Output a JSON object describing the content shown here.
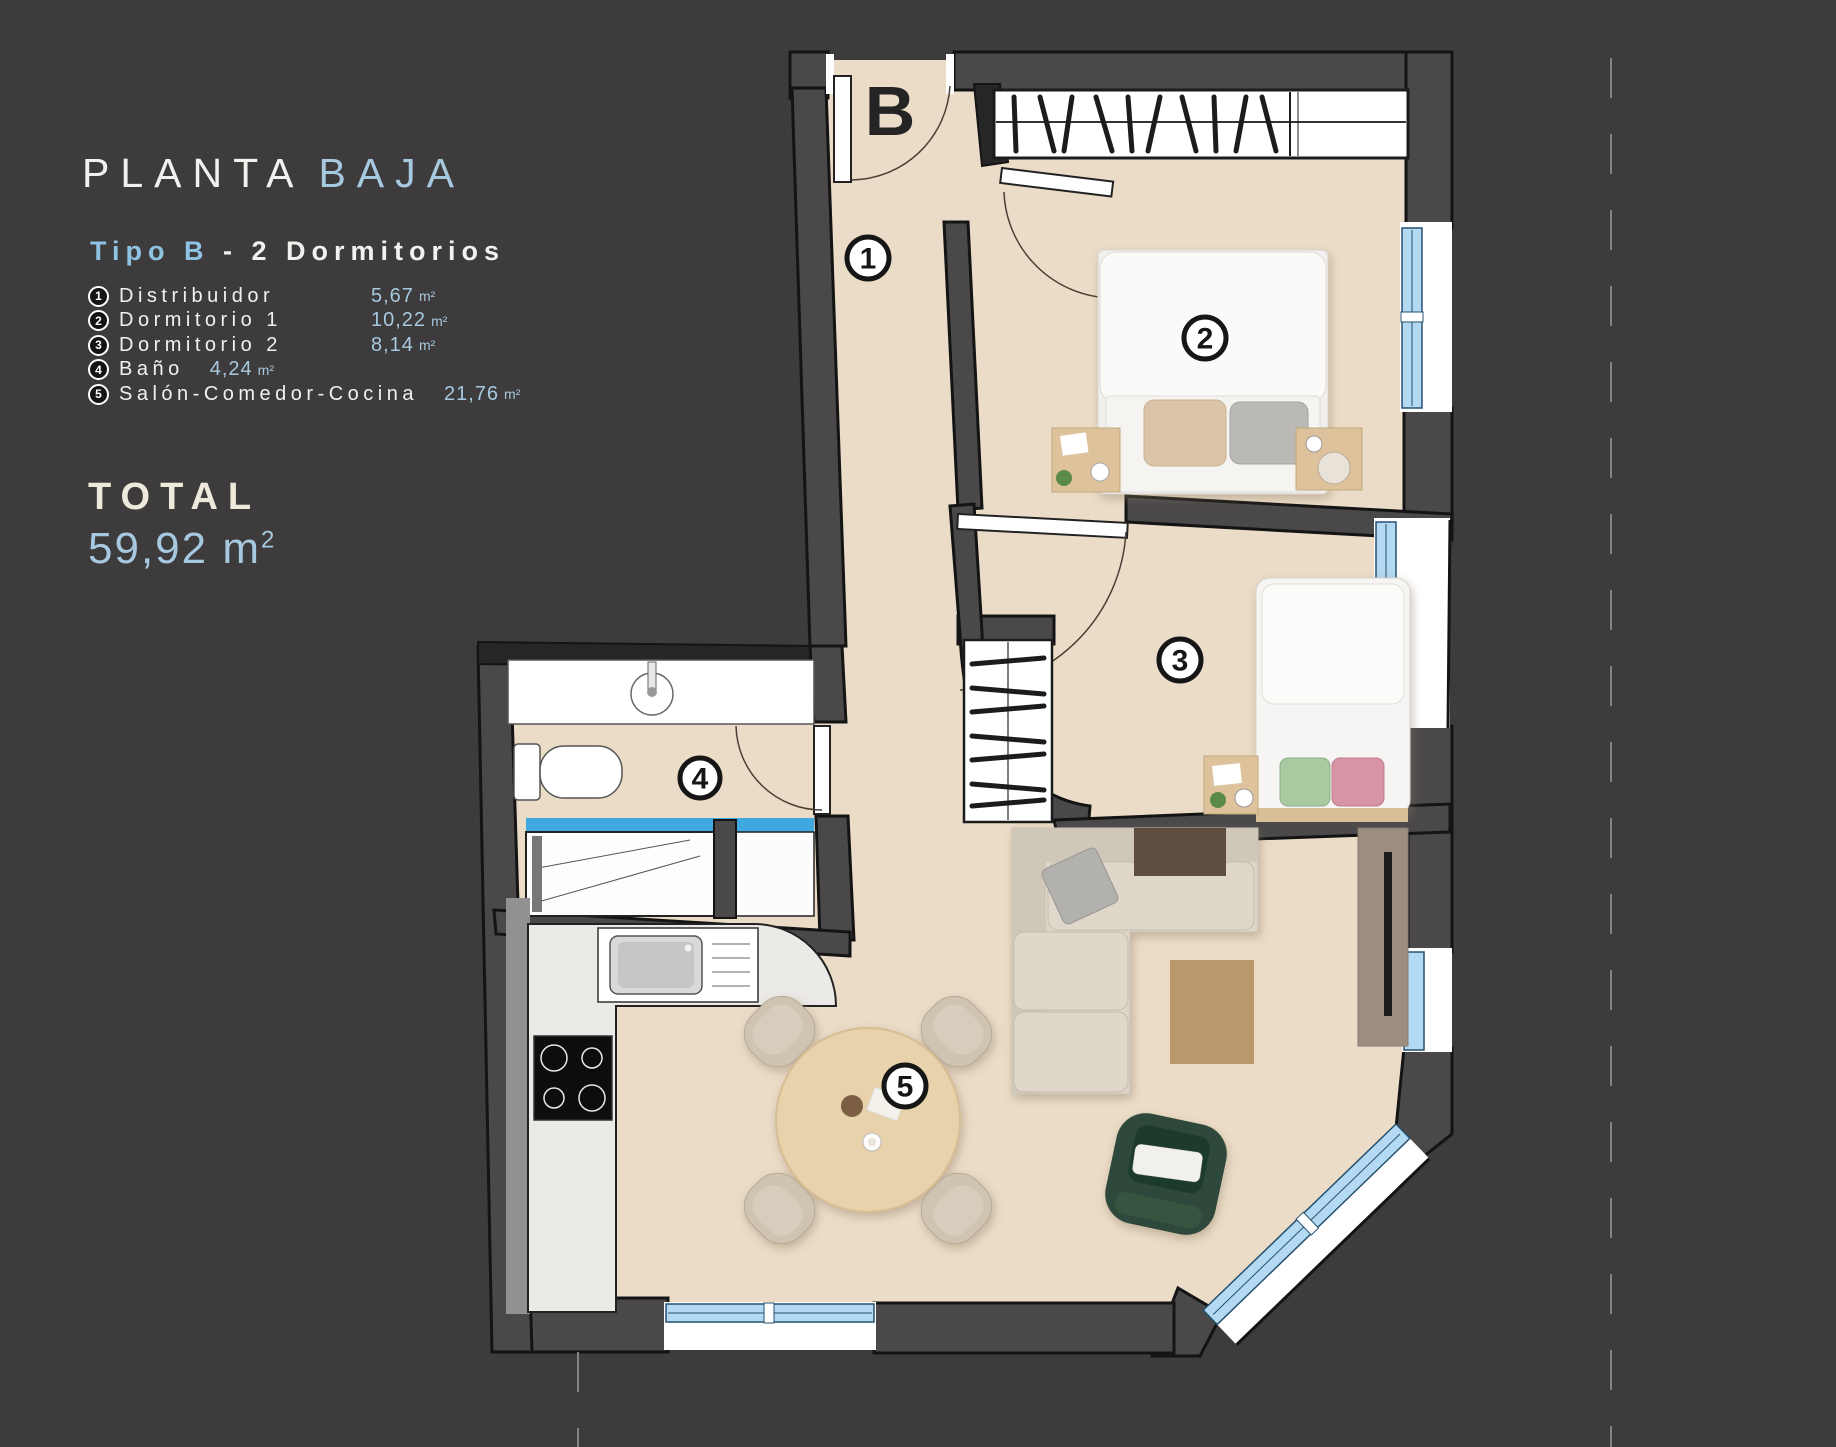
{
  "title": {
    "part1": "PLANTA",
    "part2": "BAJA"
  },
  "subtitle": {
    "part1": "Tipo B",
    "part2": "- 2 Dormitorios"
  },
  "legend": {
    "items": [
      {
        "num": "1",
        "label": "Distribuidor",
        "value": "5,67",
        "unit": "m²"
      },
      {
        "num": "2",
        "label": "Dormitorio 1",
        "value": "10,22",
        "unit": "m²"
      },
      {
        "num": "3",
        "label": "Dormitorio 2",
        "value": "8,14",
        "unit": "m²"
      },
      {
        "num": "4",
        "label": "Baño",
        "value": "4,24",
        "unit": "m²"
      },
      {
        "num": "5",
        "label": "Salón-Comedor-Cocina",
        "value": "21,76",
        "unit": "m²"
      }
    ]
  },
  "total": {
    "label": "TOTAL",
    "value": "59,92",
    "unit": "m",
    "sup": "2"
  },
  "plan": {
    "block_letter": "B",
    "markers": {
      "m1": "1",
      "m2": "2",
      "m3": "3",
      "m4": "4",
      "m5": "5"
    },
    "colors": {
      "background": "#3d3b3c",
      "floor": "#ebdcc7",
      "wall": "#4a4849",
      "window_glass": "#b4d9f2",
      "accent_blue": "#a6c9df",
      "text_white": "#f2f1ee",
      "total_cream": "#efe9dc",
      "armchair_green": "#2d4a3a",
      "rug_tan": "#b9996b",
      "wood": "#e7d2ab"
    }
  }
}
